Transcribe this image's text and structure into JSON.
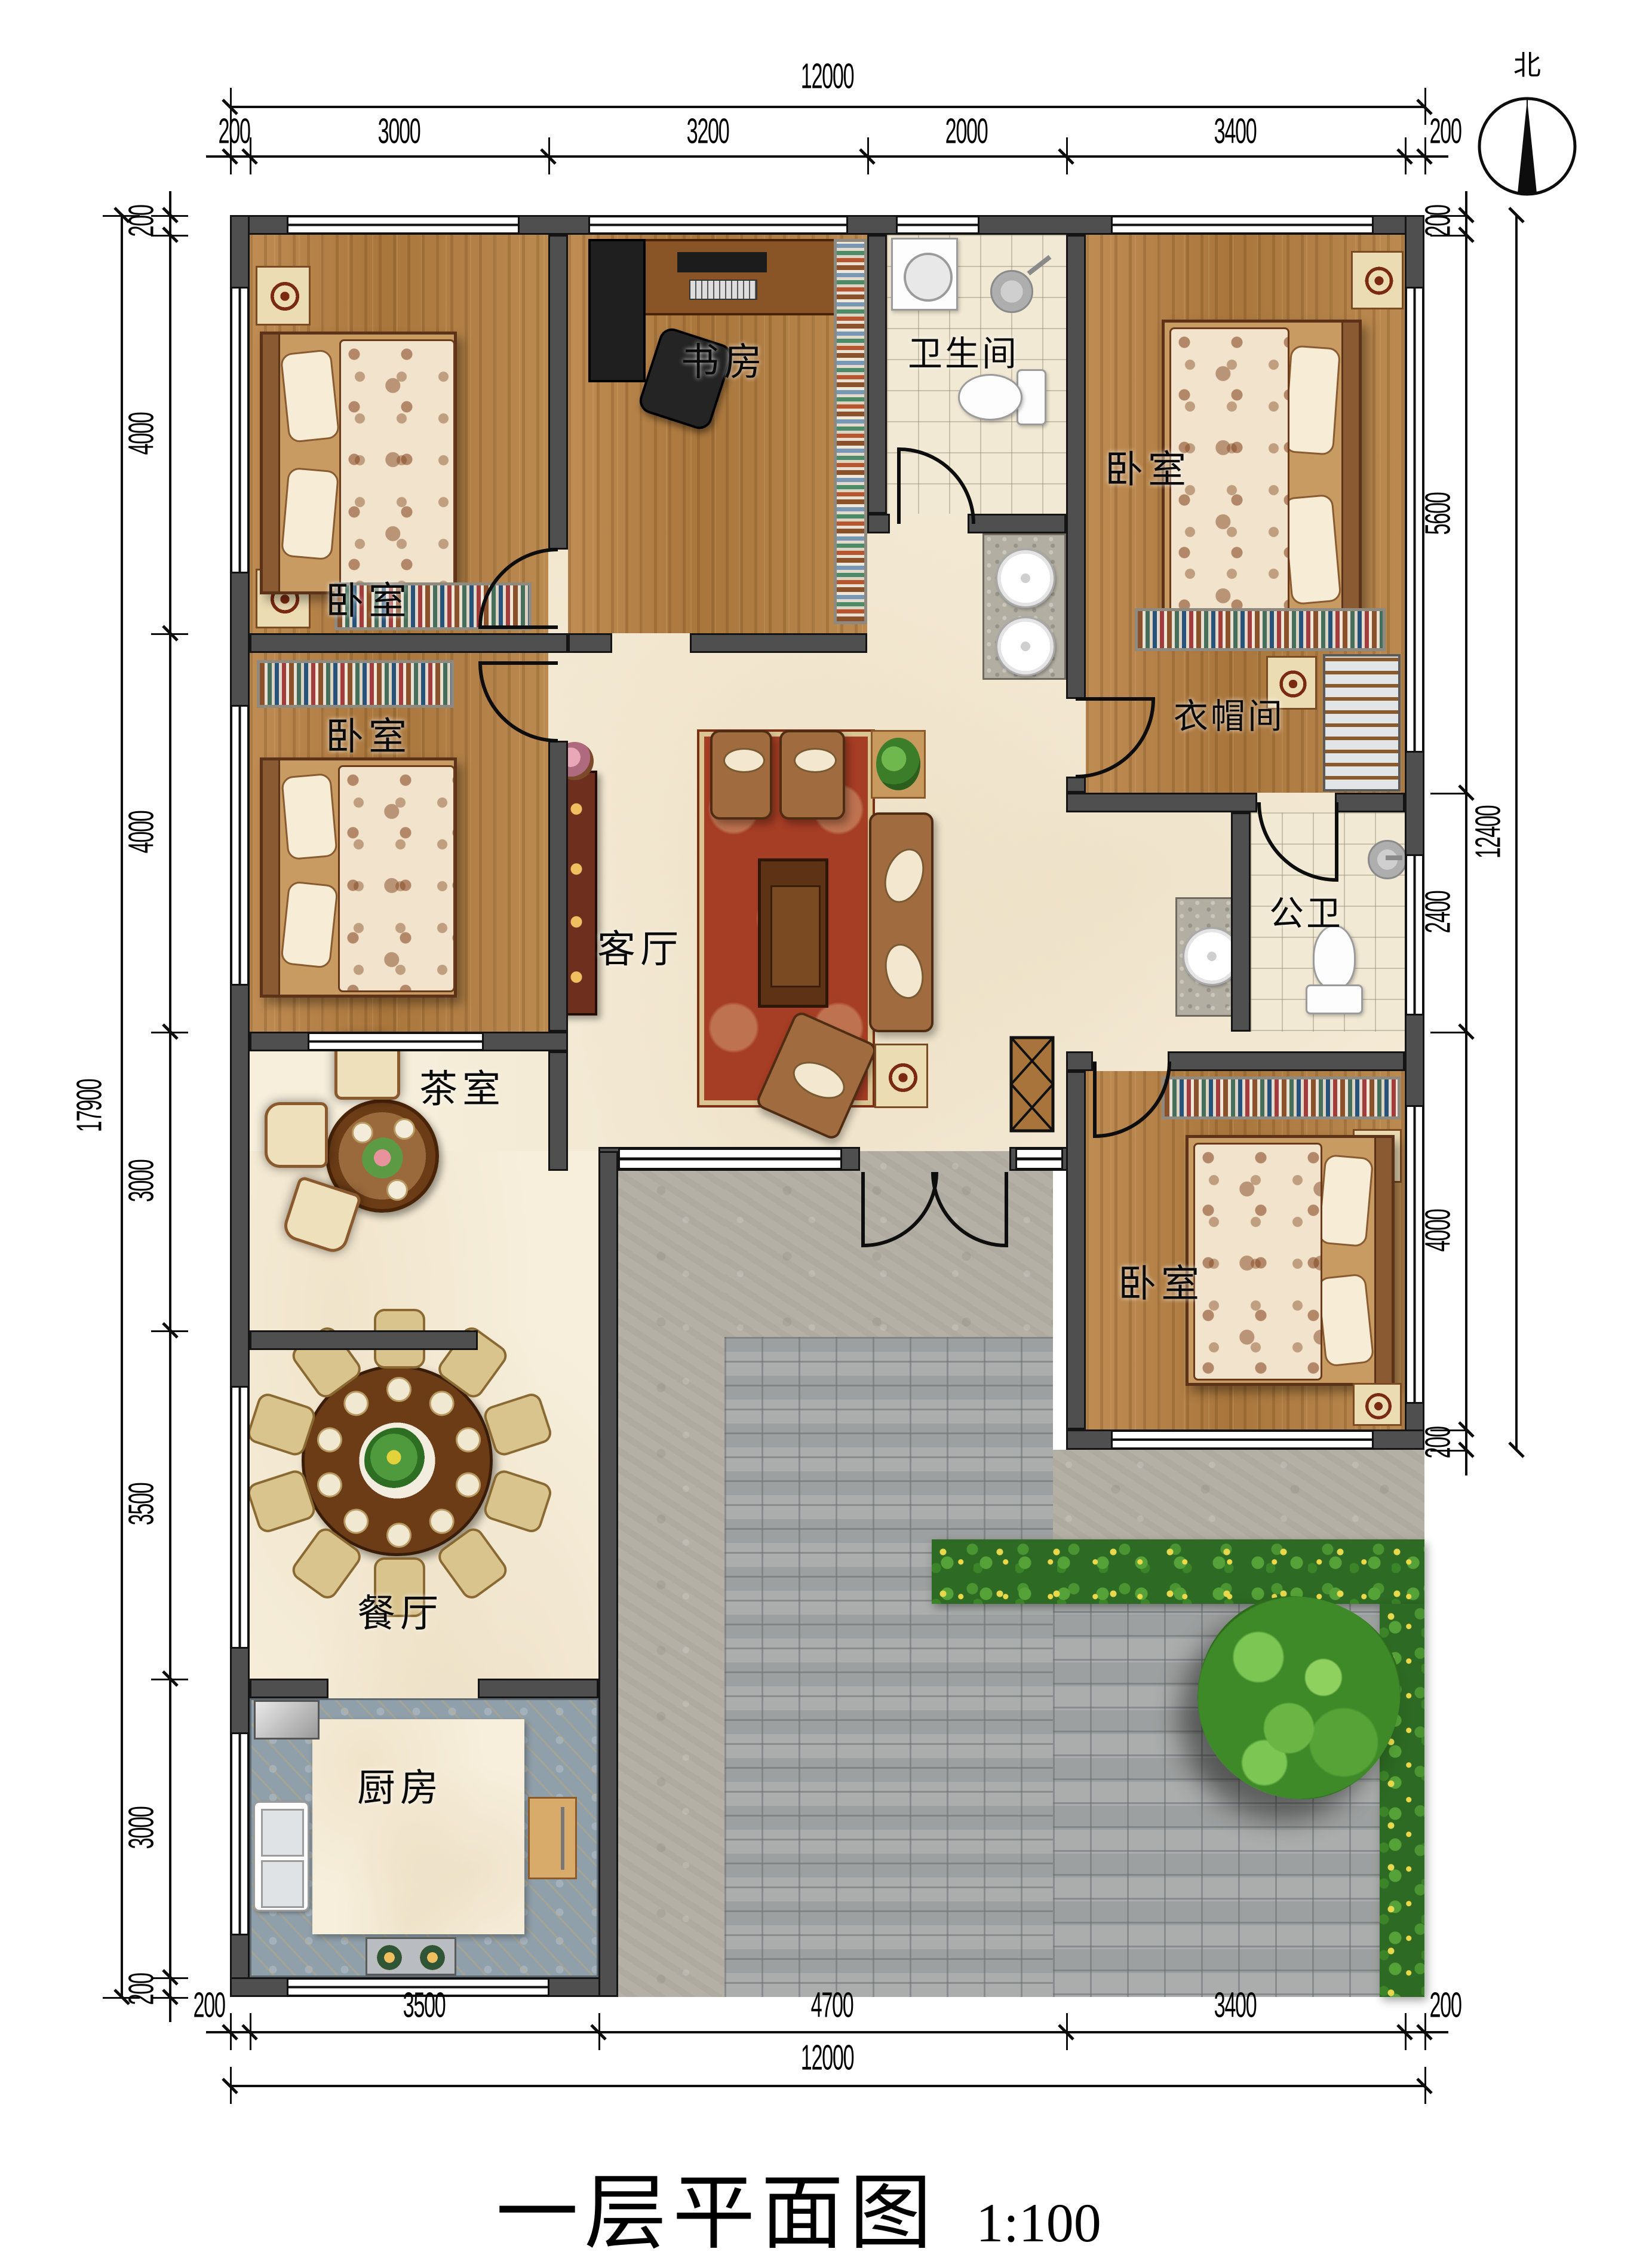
{
  "title": {
    "text": "一层平面图",
    "scale": "1:100"
  },
  "compass": {
    "label": "北"
  },
  "rooms": {
    "bedroom_top_left": {
      "label": "卧室"
    },
    "study": {
      "label": "书房"
    },
    "bathroom_top": {
      "label": "卫生间"
    },
    "bedroom_top_right": {
      "label": "卧室"
    },
    "cloakroom": {
      "label": "衣帽间"
    },
    "bedroom_mid_left": {
      "label": "卧室"
    },
    "living_room": {
      "label": "客厅"
    },
    "public_bathroom": {
      "label": "公卫"
    },
    "tea_room": {
      "label": "茶室"
    },
    "bedroom_bottom_right": {
      "label": "卧室"
    },
    "dining_room": {
      "label": "餐厅"
    },
    "kitchen": {
      "label": "厨房"
    }
  },
  "dimensions": {
    "top": {
      "total": "12000",
      "segments": [
        "200",
        "3000",
        "3200",
        "2000",
        "3400",
        "200"
      ]
    },
    "bottom": {
      "total": "12000",
      "segments": [
        "200",
        "3500",
        "4700",
        "3400",
        "200"
      ]
    },
    "left": {
      "total": "17900",
      "segments": [
        "200",
        "4000",
        "4000",
        "3000",
        "3500",
        "3000",
        "200"
      ]
    },
    "right": {
      "total": "12400",
      "segments": [
        "200",
        "5600",
        "2400",
        "4000",
        "200"
      ]
    }
  },
  "colors": {
    "wall": "#4f4f4f",
    "wood": "#b9854c",
    "marble": "#f7efdc",
    "stone": "#b5b0a6",
    "paving": "#a5a9a8",
    "hedge": "#2d6a23",
    "carpet": "#a63d25"
  }
}
